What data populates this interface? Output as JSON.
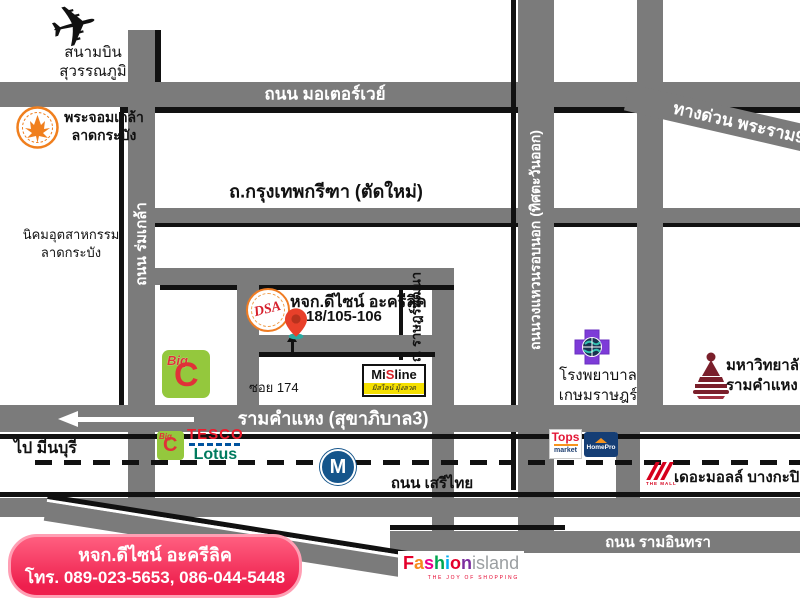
{
  "colors": {
    "road_gray": "#7b7b7b",
    "road_shadow": "#111111",
    "contact_box_bg": "#ee1f4d",
    "contact_box_border": "#ff9fb4",
    "pin_red": "#e8402a",
    "pin_base_teal": "#2aa9a0",
    "metro_blue": "#15558b",
    "bigc_green": "#94c83d",
    "bigc_red": "#e03238",
    "tesco_red": "#ee1c2e",
    "tesco_blue": "#00539f",
    "lotus_green": "#007a5e",
    "tops_red": "#e31837",
    "homepro_navy": "#153e75",
    "hospital_purple": "#7d3bd8",
    "kmitl_orange": "#f07f1e",
    "ru_maroon": "#7a1f2b",
    "themall_red": "#d6001c",
    "misline_yellow": "#f5e000",
    "dsa_orange": "#ef7c23",
    "dsa_red": "#d61f2c"
  },
  "labels": {
    "airport": {
      "line1": "สนามบิน",
      "line2": "สุวรรณภูมิ"
    },
    "motorway": "ถนน มอเตอร์เวย์",
    "expressway": "ทางด่วน พระราม9",
    "kmitl": {
      "line1": "พระจอมเกล้า",
      "line2": "ลาดกระบัง"
    },
    "krungthep_kreetha": "ถ.กรุงเทพกรีฑา (ตัดใหม่)",
    "romklao": "ถนน ร่มเกล้า",
    "industrial_estate": {
      "line1": "นิคมอุตสาหกรรม",
      "line2": "ลาดกระบัง"
    },
    "company": {
      "name": "หจก.ดีไซน์ อะครีลิค",
      "address": "18/105-106",
      "logo_text": "DSA"
    },
    "rat_phatthana": "ถ. ราษฎร์พัฒนา",
    "soi": "ซอย 174",
    "ramkhamhaeng": "รามคำแหง (สุขาภิบาล3)",
    "to_minburi": "ไป มีนบุรี",
    "seri_thai": "ถนน เสรีไทย",
    "ring_road": "ถนนวงแหวนรอบนอก (ทิศตะวันออก)",
    "hospital": {
      "line1": "โรงพยาบาล",
      "line2": "เกษมราษฎร์"
    },
    "university": {
      "line1": "มหาวิทยาลัย",
      "line2": "รามคำแหง"
    },
    "metro": "M",
    "bigc": {
      "word": "Big",
      "c": "C"
    },
    "tesco": {
      "line1": "TESCO",
      "line2": "Lotus"
    },
    "tops": {
      "line1": "Tops",
      "line2": "market"
    },
    "homepro": "HomePro",
    "misline": {
      "m": "Mi",
      "s": "S",
      "line": "line",
      "sub": "มิสไลน์ มุ้งลวด"
    },
    "the_mall": {
      "logo": "THE MALL",
      "name": "เดอะมอลล์ บางกะปิ"
    },
    "ram_inthra": "ถนน รามอินทรา",
    "fashion_island": {
      "letters": [
        "F",
        "a",
        "s",
        "h",
        "i",
        "o",
        "n"
      ],
      "island": "island",
      "tagline": "THE JOY OF SHOPPING"
    },
    "contact": {
      "line1": "หจก.ดีไซน์ อะครีลิค",
      "line2": "โทร. 089-023-5653, 086-044-5448"
    }
  }
}
